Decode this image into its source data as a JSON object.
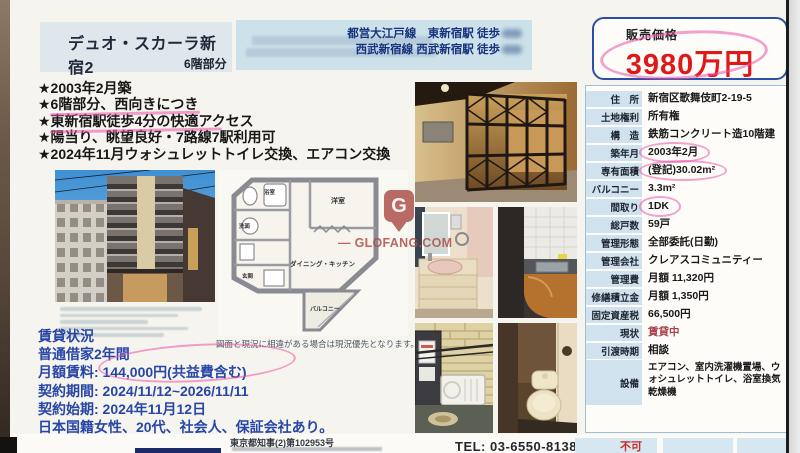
{
  "document": {
    "title": "デュオ・スカーラ新宿2",
    "floor_note": "6階部分",
    "access": {
      "line1": "都営大江戸線　東新宿駅 徒歩",
      "line2": "西武新宿線 西武新宿駅 徒歩"
    },
    "price": {
      "label": "販売価格",
      "value": "3980万円"
    },
    "highlights": [
      "★2003年2月築",
      "★6階部分、西向きにつき",
      "★東新宿駅徒歩4分の快適アクセス",
      "★陽当り、眺望良好・7路線7駅利用可",
      "★2024年11月ウォシュレットトイレ交換、エアコン交換"
    ],
    "floorplan": {
      "rooms": {
        "western_room": "洋室",
        "dining_kitchen": "ダイニング・キッチン",
        "balcony": "バルコニー",
        "bath": "浴室",
        "washroom": "洗面",
        "entrance": "玄関"
      },
      "disclaimer": "図面と現況に相違がある場合は現況優先となります。"
    },
    "details": {
      "rows": [
        {
          "label": "住　所",
          "value": "新宿区歌舞伎町2-19-5"
        },
        {
          "label": "土地権利",
          "value": "所有権"
        },
        {
          "label": "構　造",
          "value": "鉄筋コンクリート造10階建"
        },
        {
          "label": "築年月",
          "value": "2003年2月",
          "circled": true
        },
        {
          "label": "専有面積",
          "value": "(登記)30.02m²",
          "circled": true
        },
        {
          "label": "バルコニー",
          "value": "3.3m²"
        },
        {
          "label": "間取り",
          "value": "1DK",
          "circled": true
        },
        {
          "label": "総戸数",
          "value": "59戸"
        },
        {
          "label": "管理形態",
          "value": "全部委託(日勤)"
        },
        {
          "label": "管理会社",
          "value": "クレアスコミュニティー"
        },
        {
          "label": "管理費",
          "value": "月額 11,320円"
        },
        {
          "label": "修繕積立金",
          "value": "月額 1,350円"
        },
        {
          "label": "固定資産税",
          "value": "66,500円"
        },
        {
          "label": "現状",
          "value": "賃貸中",
          "red": true
        },
        {
          "label": "引渡時期",
          "value": "相談"
        },
        {
          "label": "設備",
          "value": "エアコン、室内洗濯機置場、ウォシュレットトイレ、浴室換気乾燥機",
          "tall": true
        }
      ]
    },
    "rental": {
      "lines": [
        "賃貸状況",
        "普通借家2年間",
        "月額賃料: 144,000円(共益費含む)",
        "契約期間: 2024/11/12~2026/11/11",
        "契約始期: 2024年11月12日",
        "日本国籍女性、20代、社会人、保証会社あり。"
      ]
    },
    "footer": {
      "license": "東京都知事(2)第102953号",
      "tel": "TEL: 03-6550-8138",
      "partial_note": "不可"
    },
    "watermark": {
      "letter": "G",
      "text": "— GLOFANG.COM"
    },
    "colors": {
      "price_red": "#e01818",
      "annotation_pink": "#ec54aa",
      "info_blue": "#2746a6",
      "header_navy": "#17337d"
    }
  }
}
